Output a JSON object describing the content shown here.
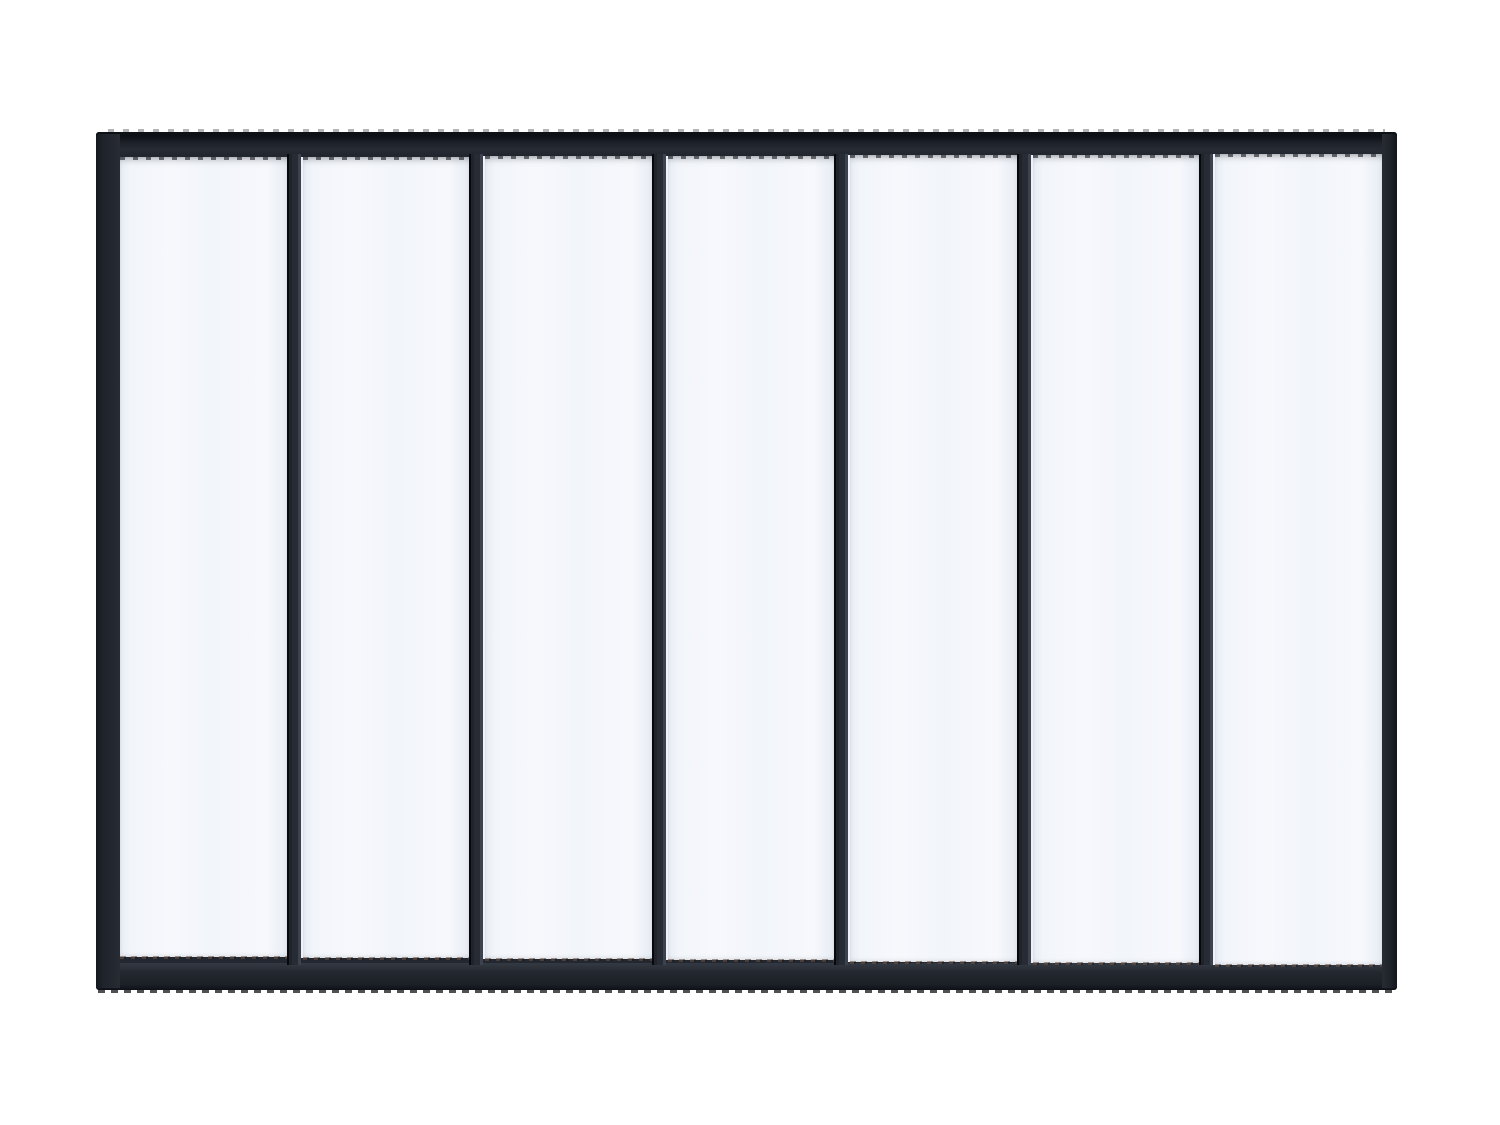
{
  "scene": {
    "type": "product-photo",
    "subject": "Black metal-framed interior glass partition (atelier loft style)",
    "background": "plain white",
    "orientation": "landscape"
  },
  "partition": {
    "panel_count": 7,
    "mullion_count": 6,
    "frame_look": "matte black metal with thin vertical mullions, thicker bottom rail",
    "glass_look": "translucent frosted white-blue glass panes"
  },
  "colors": {
    "background": "#ffffff",
    "frame": "#23272f",
    "frame_highlight": "#343a44",
    "frame_edge_dark": "#0d1015",
    "mullion": "#272c34",
    "mullion_edge": "#06080b",
    "glass": "#f2f5fa",
    "glass_bright": "#f6f8fc",
    "glass_edge": "#e7ecf4",
    "rust_edge": "#6b5044"
  }
}
